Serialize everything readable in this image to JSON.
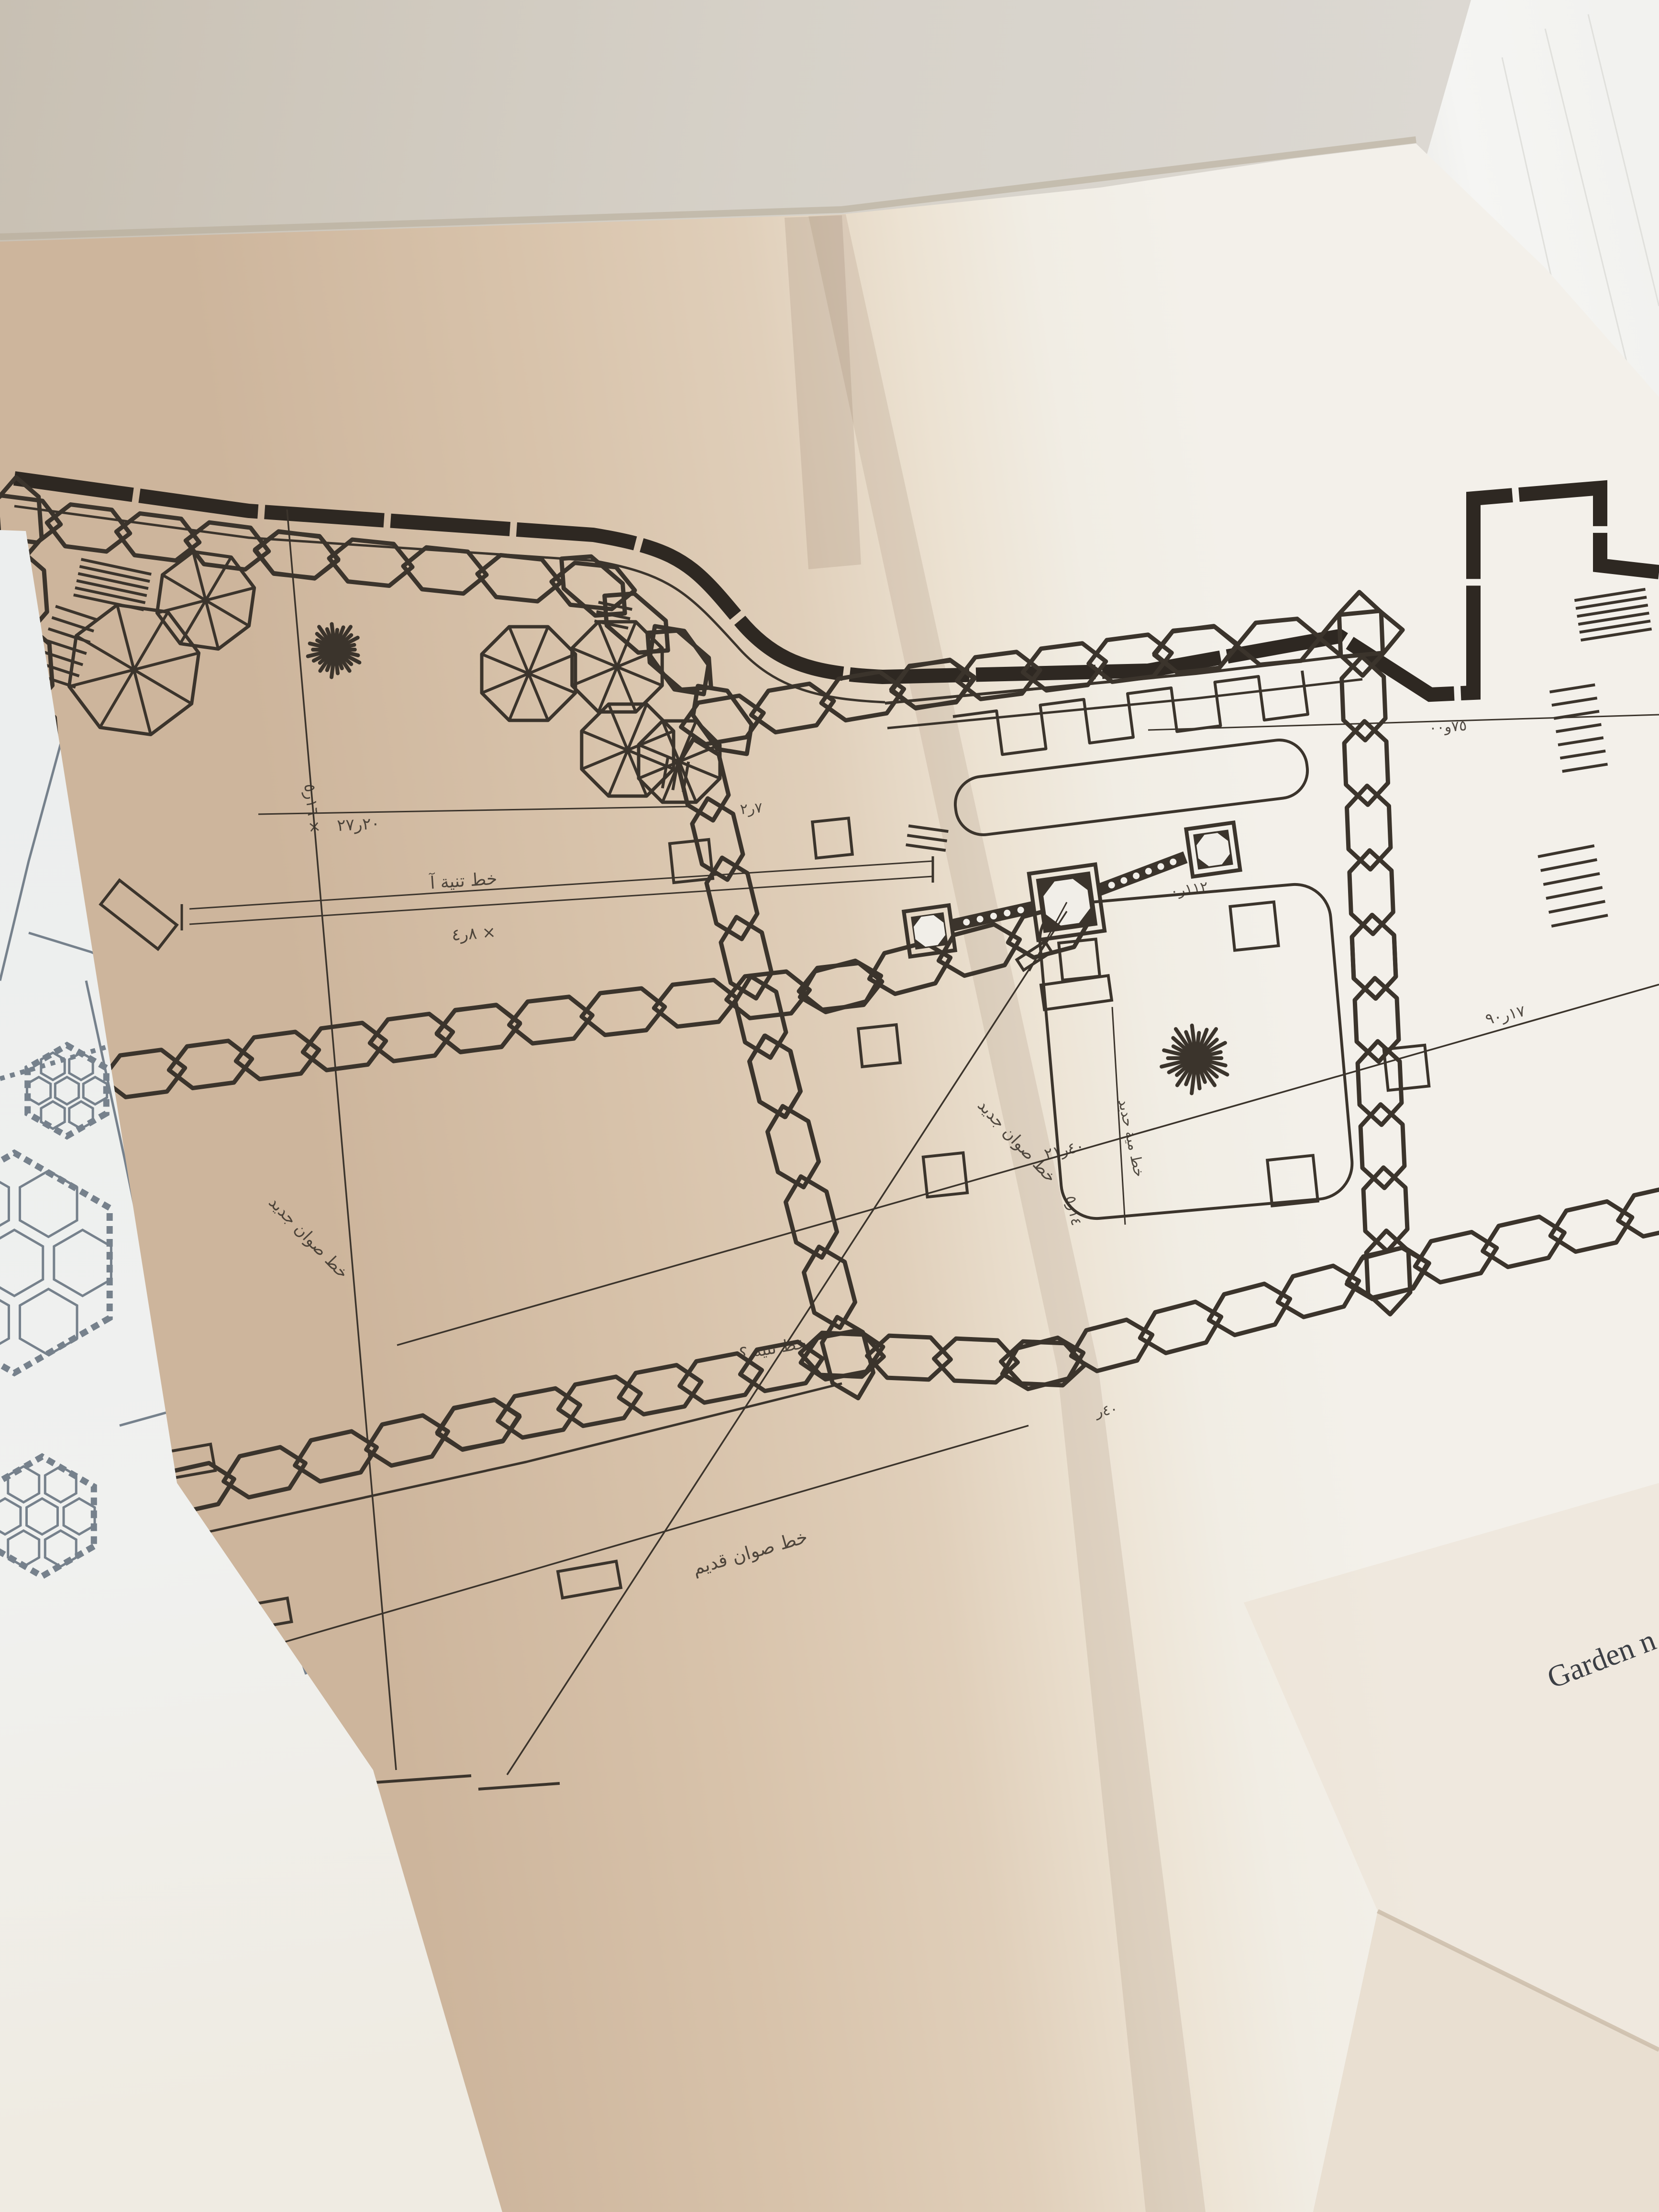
{
  "photo": {
    "caption_fragment": "Garden n",
    "plan_annotations": {
      "taniya_line": "خط تنية آ",
      "dim_8_4": "٨ر٤ ×",
      "dim_27_20": "٢٠ر٢٧",
      "dim_16_5": "١٦ر٥ ×",
      "dim_7_2": "٧ر٢",
      "dim_112": "١١٢ر٠",
      "dim_21_40": "٤٠ر٢١",
      "dim_14_5": "١٤ر٥",
      "dim_17_90": "١٧ر٩٠",
      "dim_75": "٧٥و٠٠",
      "dim_40": "٤٠ر",
      "old_stone_line": "خط صوان قديم",
      "new_stone_line": "خط صوان جديد",
      "taniya_query": "خط تنية ؟",
      "iron_pipe_line": "خط مية حديد"
    },
    "colors": {
      "ink": "#3b342c",
      "slate": "#76818c",
      "paper_tan": "#d7c2aa",
      "paper_white": "#f1eee8",
      "wall_background": "#d3ccc1",
      "table": "#e9dfd1",
      "standing_page": "#f4f4f1",
      "caption_ink": "#3c3f45"
    }
  }
}
